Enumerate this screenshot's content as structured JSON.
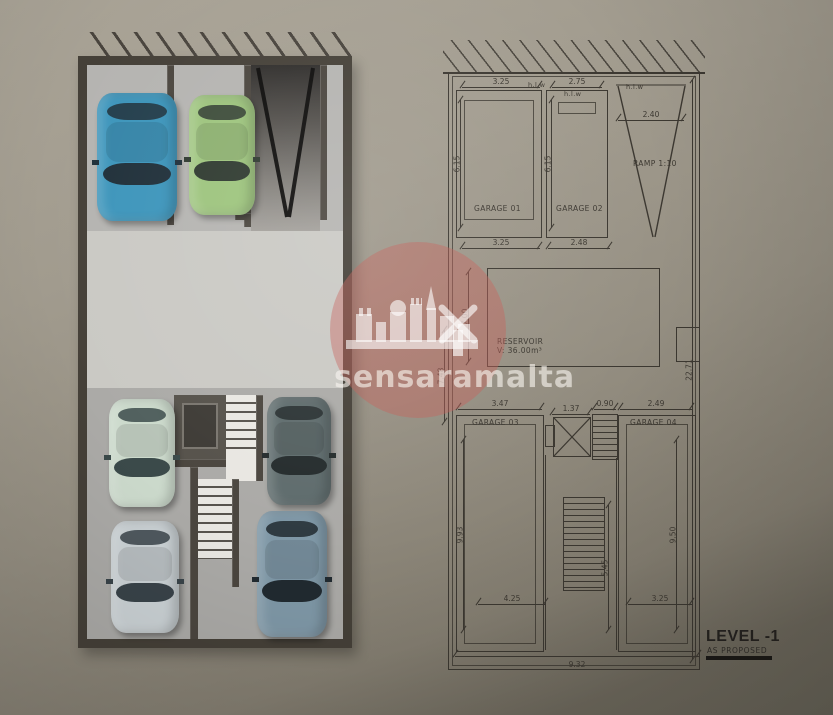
{
  "watermark": {
    "brand": "sensaramalta"
  },
  "right_plan": {
    "labels": {
      "garage01": "GARAGE 01",
      "garage02": "GARAGE 02",
      "garage03": "GARAGE 03",
      "garage04": "GARAGE 04",
      "reservoir_title": "RESERVOIR",
      "reservoir_volume": "V: 36.00m³",
      "ramp": "RAMP 1:10",
      "hlw_1": "h.l.w",
      "hlw_2": "h.l.w",
      "hlw_3": "h.l.w"
    },
    "dims": {
      "top_g1_width": "3.25",
      "top_g2_width": "2.75",
      "ramp_width": "2.40",
      "g1_depth": "6.15",
      "g2_depth": "6.15",
      "mid_g1_width": "3.25",
      "mid_g2_width": "2.48",
      "reservoir_depth": "7.00",
      "reservoir_outer": "7.48",
      "site_depth": "22.71",
      "g3_width": "3.47",
      "lift_width": "1.37",
      "stair_width": "0.90",
      "g4_width": "2.49",
      "g3_depth": "9.93",
      "g4_depth": "9.50",
      "stair_run": "5.45",
      "bottom_left_width": "4.25",
      "bottom_right_width": "3.25",
      "site_width": "9.32"
    },
    "title": {
      "level": "LEVEL -1",
      "status": "AS PROPOSED"
    }
  }
}
